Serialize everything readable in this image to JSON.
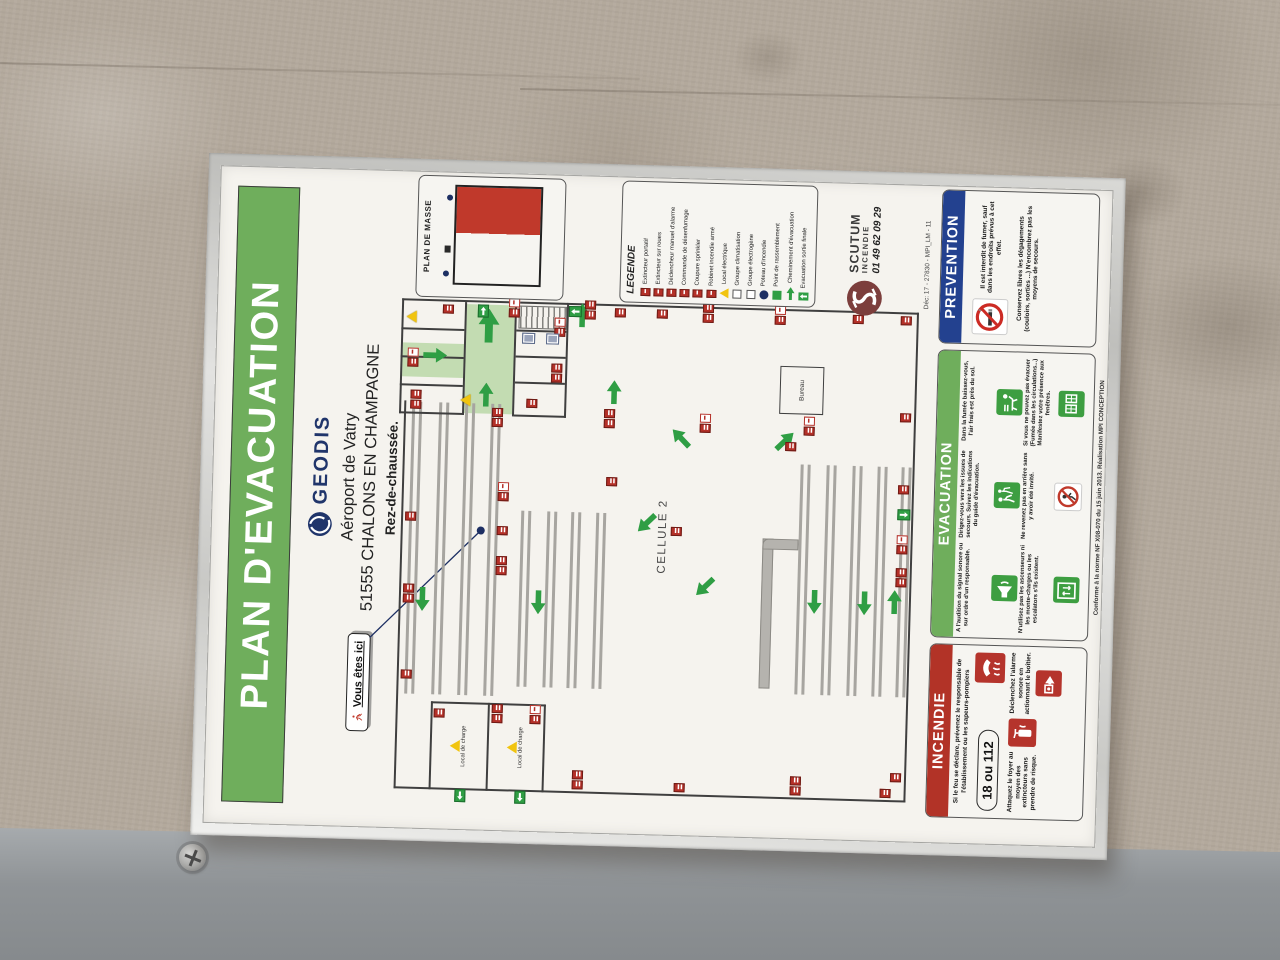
{
  "colors": {
    "title_green": "#6fae5c",
    "fire_red": "#b23327",
    "prevention_blue": "#23418f",
    "geodis_navy": "#20356b",
    "scutum_red": "#7c3e3c",
    "exit_green": "#2f9e44"
  },
  "poster": {
    "title": "PLAN D'EVACUATION",
    "header": {
      "brand": "GEODIS",
      "line1": "Aéroport de Vatry",
      "line2": "51555 CHALONS EN CHAMPAGNE",
      "line3": "Rez-de-chaussée."
    },
    "you_are_here": "Vous êtes ici",
    "plan_de_masse": {
      "label": "PLAN DE MASSE"
    },
    "cell_label": "CELLULE 2",
    "rooms": {
      "bureau": "Bureau",
      "local": "Local de charge"
    },
    "legend": {
      "title": "LEGENDE",
      "items": [
        {
          "label": "Extincteur portatif",
          "icon": "red"
        },
        {
          "label": "Extincteur sur roues",
          "icon": "red"
        },
        {
          "label": "Déclencheur manuel d'alarme",
          "icon": "red"
        },
        {
          "label": "Commande de désenfumage",
          "icon": "red"
        },
        {
          "label": "Coupure sprinkler",
          "icon": "red"
        },
        {
          "label": "Robinet incendie armé",
          "icon": "red"
        },
        {
          "label": "Local électrique",
          "icon": "warn"
        },
        {
          "label": "Groupe climatisation",
          "icon": "sq"
        },
        {
          "label": "Groupe électrogène",
          "icon": "sq"
        },
        {
          "label": "Poteau d'incendie",
          "icon": "dot"
        },
        {
          "label": "Point de rassemblement",
          "icon": "green"
        },
        {
          "label": "Cheminement d'évacuation",
          "icon": "arrow"
        },
        {
          "label": "Evacuation sortie finale",
          "icon": "exit"
        }
      ]
    },
    "scutum": {
      "name": "SCUTUM",
      "sub": "INCENDIE",
      "phone": "01 49 62 09 29",
      "ref": "Déc: 17 - 27830 - MPI_LM - 11"
    },
    "panels": {
      "incendie": {
        "title": "INCENDIE",
        "text1": "Si le feu se déclare, prévenez le responsable de l'établissement ou les sapeurs-pompiers",
        "number": "18 ou 112",
        "text2": "Attaquez le foyer au moyen des extincteurs sans prendre de risque.",
        "text3": "Déclenchez l'alarme sonore en actionnant le boîtier."
      },
      "evacuation": {
        "title": "EVACUATION",
        "items": [
          {
            "icon": "horn",
            "text": "A l'audition du signal sonore ou sur ordre d'un responsable."
          },
          {
            "icon": "guide",
            "text": "Dirigez-vous vers les issues de secours. Suivez les indications du guide d'évacuation."
          },
          {
            "icon": "crawl",
            "text": "Dans la fumée baissez-vous, l'air frais est près du sol."
          },
          {
            "icon": "lift",
            "text": "N'utilisez pas les ascenseurs ni les monte-charges ou les escalators s'ils existent."
          },
          {
            "icon": "noreturn",
            "text": "Ne revenez pas en arrière sans y avoir été invité."
          },
          {
            "icon": "window",
            "text": "Si vous ne pouvez pas évacuer (Fumée dans les circulations...) Manifestez votre présence aux fenêtres."
          }
        ]
      },
      "prevention": {
        "title": "PREVENTION",
        "text1": "Il est interdit de fumer, sauf dans les endroits prévus à cet effet.",
        "text2": "Conservez libres les dégagements (couloirs, sorties ...) N'encombrez pas les moyens de secours."
      }
    },
    "footnote": "Conforme à la norme NF X08-070 du 15 juin 2013. Réalisation MPI CONCEPTION",
    "plan": {
      "corridors": [
        {
          "x": 417,
          "y": 250,
          "w": 109,
          "h": 48
        },
        {
          "x": 452,
          "y": 187,
          "w": 34,
          "h": 61
        }
      ],
      "walls": [
        {
          "x": 40,
          "y": 190,
          "w": 388,
          "h": 2
        },
        {
          "x": 40,
          "y": 190,
          "w": 2,
          "h": 512
        },
        {
          "x": 40,
          "y": 700,
          "w": 490,
          "h": 2
        },
        {
          "x": 528,
          "y": 185,
          "w": 2,
          "h": 517
        },
        {
          "x": 40,
          "y": 225,
          "w": 88,
          "h": 2
        },
        {
          "x": 40,
          "y": 338,
          "w": 88,
          "h": 2
        },
        {
          "x": 126,
          "y": 225,
          "w": 2,
          "h": 115
        },
        {
          "x": 40,
          "y": 282,
          "w": 88,
          "h": 2
        },
        {
          "x": 415,
          "y": 185,
          "w": 115,
          "h": 2
        },
        {
          "x": 415,
          "y": 350,
          "w": 115,
          "h": 2
        },
        {
          "x": 415,
          "y": 185,
          "w": 2,
          "h": 65
        },
        {
          "x": 415,
          "y": 300,
          "w": 2,
          "h": 52
        },
        {
          "x": 443,
          "y": 185,
          "w": 2,
          "h": 63
        },
        {
          "x": 471,
          "y": 185,
          "w": 2,
          "h": 63
        },
        {
          "x": 499,
          "y": 185,
          "w": 2,
          "h": 63
        },
        {
          "x": 415,
          "y": 248,
          "w": 113,
          "h": 2
        },
        {
          "x": 415,
          "y": 298,
          "w": 113,
          "h": 2
        },
        {
          "x": 448,
          "y": 300,
          "w": 2,
          "h": 50
        },
        {
          "x": 474,
          "y": 300,
          "w": 2,
          "h": 50
        },
        {
          "x": 500,
          "y": 300,
          "w": 2,
          "h": 50
        }
      ],
      "racks": [
        {
          "x": 135,
          "y": 198,
          "w": 292
        },
        {
          "x": 135,
          "y": 225,
          "w": 292
        },
        {
          "x": 135,
          "y": 251,
          "w": 292
        },
        {
          "x": 135,
          "y": 277,
          "w": 292
        },
        {
          "x": 145,
          "y": 310,
          "w": 176
        },
        {
          "x": 145,
          "y": 336,
          "w": 176
        },
        {
          "x": 145,
          "y": 360,
          "w": 176
        },
        {
          "x": 145,
          "y": 385,
          "w": 176
        },
        {
          "x": 145,
          "y": 588,
          "w": 230
        },
        {
          "x": 145,
          "y": 614,
          "w": 230
        },
        {
          "x": 145,
          "y": 640,
          "w": 230
        },
        {
          "x": 145,
          "y": 665,
          "w": 230
        },
        {
          "x": 145,
          "y": 689,
          "w": 230
        }
      ],
      "markers": [
        {
          "t": "exit",
          "x": 516,
          "y": 352,
          "r": 0
        },
        {
          "t": "ext2",
          "x": 514,
          "y": 368
        },
        {
          "t": "ext",
          "x": 517,
          "y": 398
        },
        {
          "t": "ext",
          "x": 517,
          "y": 440
        },
        {
          "t": "ext2",
          "x": 514,
          "y": 486
        },
        {
          "t": "exw",
          "x": 514,
          "y": 558
        },
        {
          "t": "ext",
          "x": 517,
          "y": 636
        },
        {
          "t": "ext",
          "x": 517,
          "y": 684
        },
        {
          "t": "ext",
          "x": 60,
          "y": 686
        },
        {
          "t": "ext2",
          "x": 255,
          "y": 686
        },
        {
          "t": "exw",
          "x": 288,
          "y": 686
        },
        {
          "t": "exit",
          "x": 322,
          "y": 686,
          "r": 180
        },
        {
          "t": "ext",
          "x": 348,
          "y": 686
        },
        {
          "t": "ext",
          "x": 420,
          "y": 686
        },
        {
          "t": "exit",
          "x": 29,
          "y": 250,
          "r": -90
        },
        {
          "t": "exit",
          "x": 29,
          "y": 310,
          "r": -90
        },
        {
          "t": "ext2",
          "x": 44,
          "y": 368
        },
        {
          "t": "ext",
          "x": 44,
          "y": 470
        },
        {
          "t": "ext2",
          "x": 44,
          "y": 586
        },
        {
          "t": "ext",
          "x": 44,
          "y": 676
        },
        {
          "t": "ext",
          "x": 150,
          "y": 194
        },
        {
          "t": "ext2",
          "x": 226,
          "y": 194
        },
        {
          "t": "ext",
          "x": 308,
          "y": 194
        },
        {
          "t": "ext",
          "x": 112,
          "y": 228
        },
        {
          "t": "ext2",
          "x": 108,
          "y": 286
        },
        {
          "t": "exw",
          "x": 108,
          "y": 324
        },
        {
          "t": "ext2",
          "x": 256,
          "y": 286
        },
        {
          "t": "ext",
          "x": 296,
          "y": 286
        },
        {
          "t": "exw",
          "x": 330,
          "y": 286
        },
        {
          "t": "ext2",
          "x": 404,
          "y": 278
        },
        {
          "t": "ext",
          "x": 348,
          "y": 394
        },
        {
          "t": "ext2",
          "x": 406,
          "y": 390
        },
        {
          "t": "exw",
          "x": 404,
          "y": 486
        },
        {
          "t": "exw",
          "x": 404,
          "y": 590
        },
        {
          "t": "ext",
          "x": 300,
          "y": 460
        },
        {
          "t": "ext",
          "x": 388,
          "y": 572
        },
        {
          "t": "ext2",
          "x": 420,
          "y": 196
        },
        {
          "t": "exw",
          "x": 462,
          "y": 192
        },
        {
          "t": "ext",
          "x": 516,
          "y": 226
        },
        {
          "t": "exw",
          "x": 514,
          "y": 292
        },
        {
          "t": "ext",
          "x": 424,
          "y": 312
        },
        {
          "t": "ext2",
          "x": 450,
          "y": 336
        },
        {
          "t": "exw",
          "x": 496,
          "y": 338
        },
        {
          "t": "blue",
          "x": 488,
          "y": 306
        },
        {
          "t": "blue",
          "x": 488,
          "y": 330
        },
        {
          "t": "warn",
          "x": 424,
          "y": 246
        },
        {
          "t": "warn",
          "x": 506,
          "y": 190
        },
        {
          "t": "exit",
          "x": 514,
          "y": 260,
          "r": 90
        },
        {
          "t": "dot",
          "x": 296,
          "y": 266
        }
      ],
      "arrows": [
        {
          "x": 218,
          "y": 206,
          "d": 180
        },
        {
          "x": 218,
          "y": 322,
          "d": 180
        },
        {
          "x": 226,
          "y": 598,
          "d": 180
        },
        {
          "x": 226,
          "y": 648,
          "d": 180
        },
        {
          "x": 228,
          "y": 678,
          "d": 0
        },
        {
          "x": 386,
          "y": 460,
          "d": -45
        },
        {
          "x": 386,
          "y": 564,
          "d": 45
        },
        {
          "x": 238,
          "y": 488,
          "d": -135
        },
        {
          "x": 300,
          "y": 428,
          "d": -135
        },
        {
          "x": 430,
          "y": 392,
          "d": 0
        },
        {
          "x": 488,
          "y": 262,
          "d": 0,
          "big": true
        },
        {
          "x": 424,
          "y": 264,
          "d": 0
        },
        {
          "x": 462,
          "y": 212,
          "d": 90
        },
        {
          "x": 506,
          "y": 358,
          "d": 0
        }
      ]
    }
  }
}
